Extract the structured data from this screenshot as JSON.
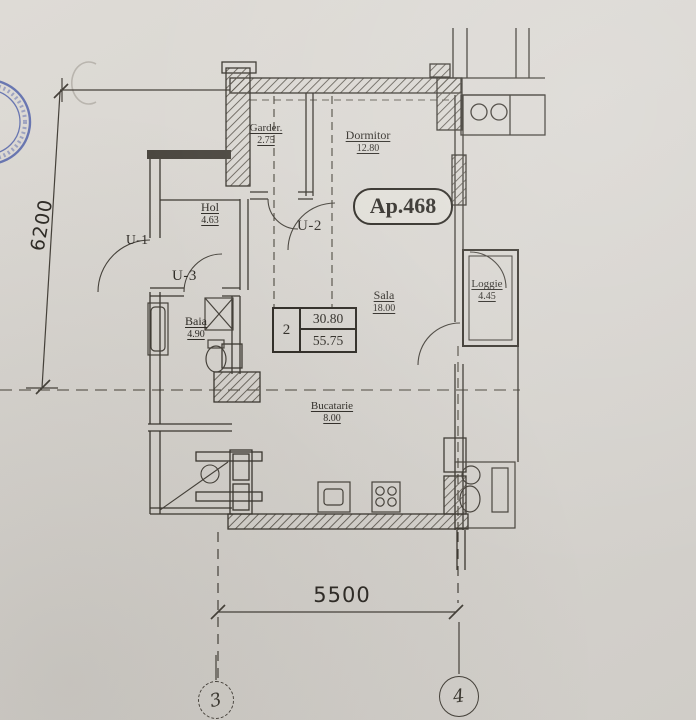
{
  "plan": {
    "apartment_label": "Ap.468",
    "rooms": {
      "garder": {
        "name": "Garder.",
        "area": "2.75"
      },
      "dormitor": {
        "name": "Dormitor",
        "area": "12.80"
      },
      "hol": {
        "name": "Hol",
        "area": "4.63"
      },
      "baia": {
        "name": "Baia",
        "area": "4.90"
      },
      "sala": {
        "name": "Sala",
        "area": "18.00"
      },
      "loggie": {
        "name": "Loggie",
        "area": "4.45"
      },
      "bucatarie": {
        "name": "Bucatarie",
        "area": "8.00"
      }
    },
    "doors": {
      "u1": {
        "label": "U-1"
      },
      "u2": {
        "label": "U-2"
      },
      "u3": {
        "label": "U-3"
      }
    },
    "summary_table": {
      "rooms_count": "2",
      "living_area": "30.80",
      "total_area": "55.75"
    },
    "dimensions": {
      "vertical_mm": "6200",
      "horizontal_mm": "5500"
    },
    "axes": {
      "left": {
        "label": "3"
      },
      "right": {
        "label": "4"
      }
    },
    "colors": {
      "paper": "#d8d5d0",
      "ink": "#38342e",
      "stamp": "#4356a6"
    }
  }
}
